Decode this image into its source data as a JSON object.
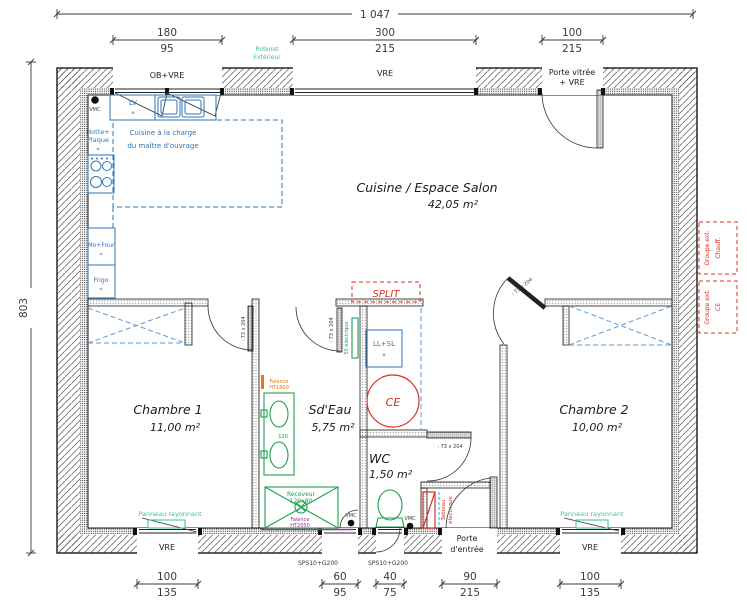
{
  "colors": {
    "wall": "#1a1a1a",
    "hatch": "#555555",
    "dim": "#3a3a3a",
    "blue": "#2E75B6",
    "lightblue": "#5B9BD5",
    "skyblue": "#2BA3E0",
    "green": "#1E9E50",
    "mint": "#45BE8E",
    "teal": "#35C0A5",
    "red": "#D93025",
    "orange": "#E07B10",
    "purple": "#993399"
  },
  "dims": {
    "total_width": "1 047",
    "total_height": "803",
    "top": [
      {
        "a": "180",
        "b": "95"
      },
      {
        "a": "300",
        "b": "215"
      },
      {
        "a": "100",
        "b": "215"
      }
    ],
    "bottom": [
      {
        "a": "100",
        "b": "135"
      },
      {
        "a": "60",
        "b": "95"
      },
      {
        "a": "40",
        "b": "75"
      },
      {
        "a": "90",
        "b": "215"
      },
      {
        "a": "100",
        "b": "135"
      }
    ]
  },
  "rooms": {
    "living": {
      "name": "Cuisine / Espace Salon",
      "surface": "42,05 m²"
    },
    "chambre1": {
      "name": "Chambre 1",
      "surface": "11,00 m²"
    },
    "sdeau": {
      "name": "Sd'Eau",
      "surface": "5,75 m²"
    },
    "wc": {
      "name": "WC",
      "surface": "1,50 m²"
    },
    "chambre2": {
      "name": "Chambre 2",
      "surface": "10,00 m²"
    }
  },
  "openings": {
    "ob_vre": "OB+VRE",
    "vre": "VRE",
    "porte_vitree": [
      "Porte vitrée",
      "+ VRE"
    ],
    "porte_entree": [
      "Porte",
      "d'entrée"
    ],
    "sps": "SPS10+G200",
    "door_size": ": 73 x 204"
  },
  "labels": {
    "robinet": [
      "Robinet",
      "Extérieur"
    ],
    "vmc": "VMC",
    "lv": "LV",
    "asterisk": "*",
    "hotte": [
      "Hotte+",
      "Plaque"
    ],
    "cuisine_charge": [
      "Cuisine à la charge",
      "du maître d'ouvrage"
    ],
    "mo_four": "Mo+Four",
    "frigo": "Frigo",
    "split": "SPLIT",
    "ll_sl": "LL+SL",
    "ce": "CE",
    "ss_electrique": "SS électrique",
    "faience_haut": [
      "Faïence",
      "HT1800"
    ],
    "vanity_width": "120",
    "receveur": [
      "Receveur",
      "120x80"
    ],
    "faience_bas": [
      "Faïence",
      "HT2050"
    ],
    "tableau": [
      "Tableau",
      "électrique"
    ],
    "panneau": "Panneau rayonnant",
    "groupe_chauff": [
      "Groupe ext.",
      "Chauff."
    ],
    "groupe_ce": [
      "Groupe ext.",
      "CE"
    ]
  }
}
